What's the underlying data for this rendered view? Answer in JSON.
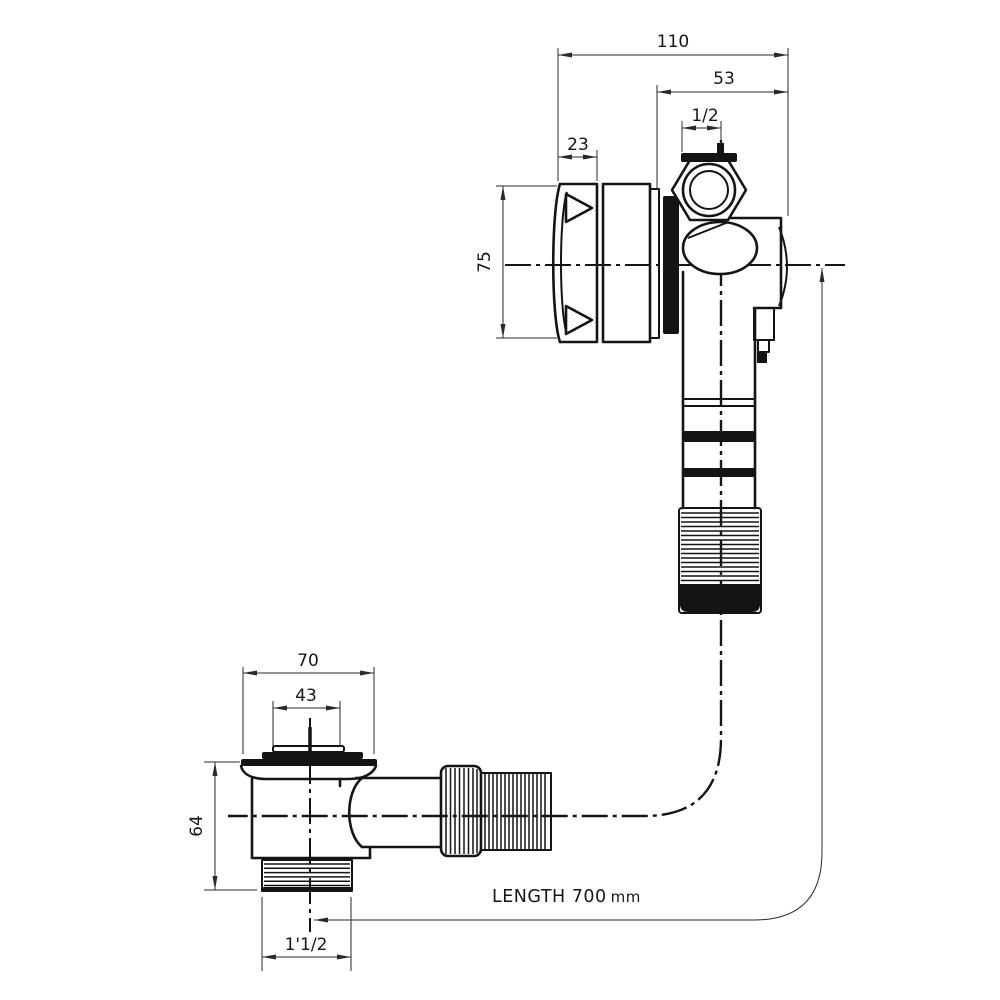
{
  "title": "Bath overflow filler and waste - technical dimension drawing",
  "colors": {
    "line": "#141414",
    "background": "#ffffff",
    "dimension": "#2a2a2a"
  },
  "overflow": {
    "total_width": "110",
    "body_width": "53",
    "top_thread": "1/2",
    "cap_depth": "23",
    "face_diameter": "75"
  },
  "waste": {
    "flange_diameter": "70",
    "plug_diameter": "43",
    "body_height": "64",
    "outlet_thread": "1'1/2"
  },
  "pipe": {
    "length_label": "LENGTH 700",
    "length_unit": "mm"
  }
}
